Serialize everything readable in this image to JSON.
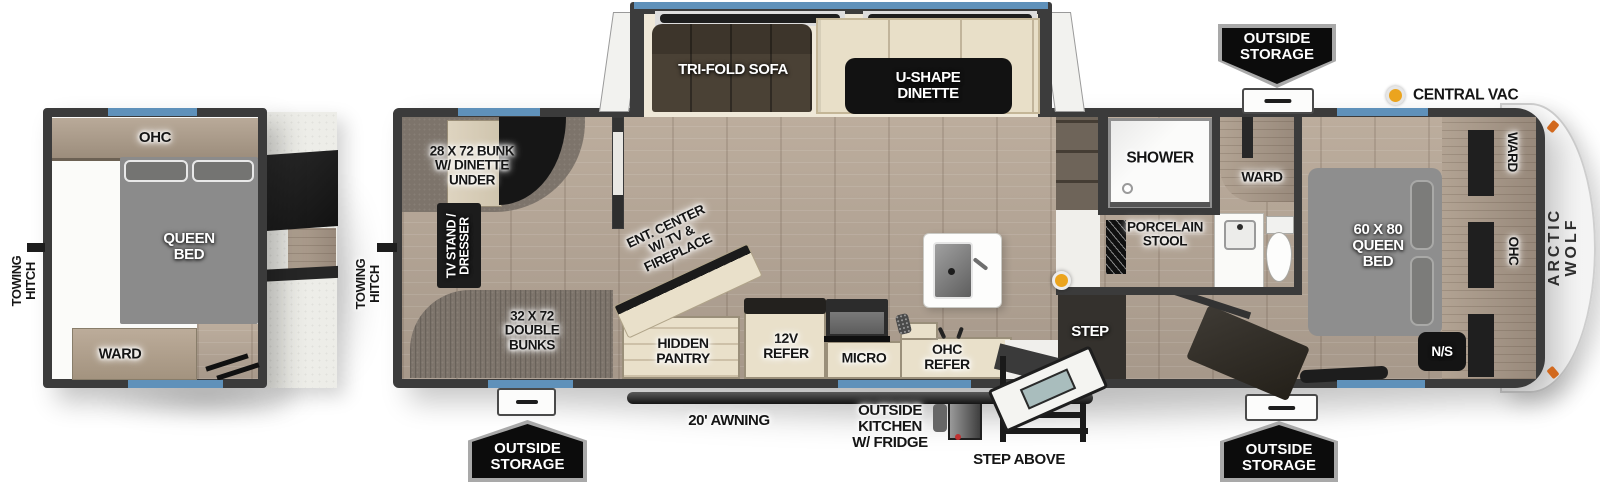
{
  "title": "Arctic Wolf travel trailer floorplan",
  "rear_unit": {
    "towing_hitch": "TOWING\nHITCH",
    "ohc": "OHC",
    "queen_bed": "QUEEN\nBED",
    "ward": "WARD"
  },
  "main_unit": {
    "towing_hitch": "TOWING\nHITCH",
    "bunk": "28 X 72 BUNK\nW/ DINETTE\nUNDER",
    "tv_stand": "TV STAND /\nDRESSER",
    "double_bunks": "32 X 72\nDOUBLE\nBUNKS",
    "ent_center": "ENT. CENTER\nW/ TV &\nFIREPLACE",
    "tri_fold_sofa": "TRI-FOLD SOFA",
    "u_shape_dinette": "U-SHAPE\nDINETTE",
    "hidden_pantry": "HIDDEN\nPANTRY",
    "refer_12v": "12V\nREFER",
    "micro": "MICRO",
    "ohc_refer": "OHC\nREFER",
    "shower": "SHOWER",
    "porcelain_stool": "PORCELAIN\nSTOOL",
    "step": "STEP",
    "ward_bath": "WARD",
    "queen_bed": "60 X 80\nQUEEN\nBED",
    "ward_front": "WARD",
    "ohc_front": "OHC",
    "night_shade": "N/S",
    "brand": "ARCTIC WOLF"
  },
  "exterior": {
    "central_vac": "CENTRAL VAC",
    "outside_storage_top": "OUTSIDE\nSTORAGE",
    "outside_storage_left": "OUTSIDE\nSTORAGE",
    "outside_storage_right": "OUTSIDE\nSTORAGE",
    "awning": "20' AWNING",
    "outside_kitchen": "OUTSIDE\nKITCHEN\nW/ FRIDGE",
    "step_above": "STEP ABOVE"
  },
  "colors": {
    "wall": "#3b3b3b",
    "window_blue": "#5f91ba",
    "floor_wood": "#b3a494",
    "carpet": "#7d746b",
    "bed_gray": "#8d8d8d",
    "furniture_cream": "#e9e0ca",
    "sofa_brown": "#4a4135",
    "vac_orange": "#eba41e",
    "badge_black": "#0c0c0c",
    "badge_border": "#a9a9a9"
  }
}
